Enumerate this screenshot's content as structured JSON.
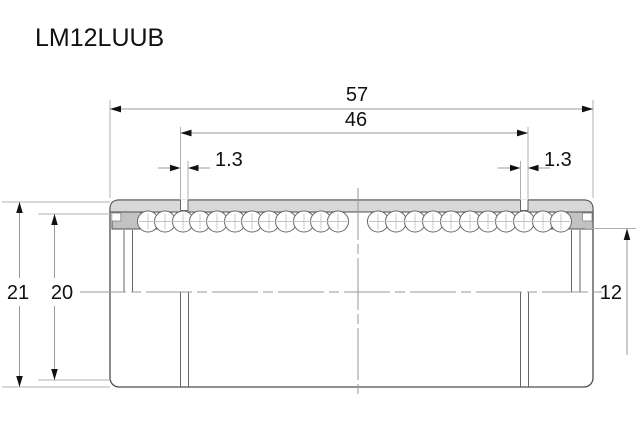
{
  "title": "LM12LUUB",
  "drawing": {
    "dim_overall_length": "57",
    "dim_groove_span": "46",
    "dim_groove_width_left": "1.3",
    "dim_groove_width_right": "1.3",
    "dim_outer_diameter": "21",
    "dim_groove_diameter": "20",
    "dim_bore_diameter": "12"
  },
  "colors": {
    "background": "#ffffff",
    "outline": "#4d4d4d",
    "sleeve_section_fill": "#d8d8d8",
    "seal_section_fill": "#c2c2c2",
    "dimension_line": "#999999",
    "text": "#111111"
  }
}
